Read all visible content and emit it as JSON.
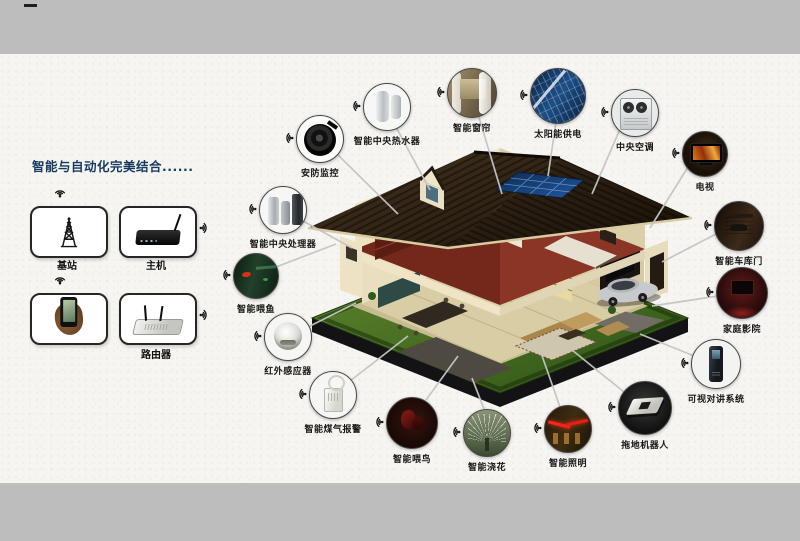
{
  "poster": {
    "title": "智能与自动化完美结合......",
    "title_color": "#15395e",
    "background_color": "#f6f5f2",
    "page_background": "#bdbdbd"
  },
  "hub": {
    "base_station": {
      "label": "基站",
      "icon": "radio-tower-icon"
    },
    "host": {
      "label": "主机",
      "icon": "set-top-host-icon"
    },
    "phone": {
      "label": "",
      "icon": "smartphone-in-hand-icon"
    },
    "router": {
      "label": "路由器",
      "icon": "router-icon"
    }
  },
  "devices": [
    {
      "label": "安防监控",
      "icon": "security-camera-icon"
    },
    {
      "label": "智能中央热水器",
      "icon": "water-heater-icon"
    },
    {
      "label": "智能窗帘",
      "icon": "curtains-icon"
    },
    {
      "label": "太阳能供电",
      "icon": "solar-panel-icon"
    },
    {
      "label": "中央空调",
      "icon": "air-conditioner-icon"
    },
    {
      "label": "电视",
      "icon": "tv-icon"
    },
    {
      "label": "智能车库门",
      "icon": "garage-door-icon"
    },
    {
      "label": "家庭影院",
      "icon": "home-theater-icon"
    },
    {
      "label": "可视对讲系统",
      "icon": "video-intercom-icon"
    },
    {
      "label": "拖地机器人",
      "icon": "mopping-robot-icon"
    },
    {
      "label": "智能照明",
      "icon": "smart-lighting-icon"
    },
    {
      "label": "智能浇花",
      "icon": "sprinkler-icon"
    },
    {
      "label": "智能喂鸟",
      "icon": "bird-feeder-icon"
    },
    {
      "label": "智能煤气报警",
      "icon": "gas-alarm-icon"
    },
    {
      "label": "红外感应器",
      "icon": "infrared-sensor-icon"
    },
    {
      "label": "智能喂鱼",
      "icon": "fish-feeder-icon"
    },
    {
      "label": "智能中央处理器",
      "icon": "central-processor-icon"
    }
  ]
}
